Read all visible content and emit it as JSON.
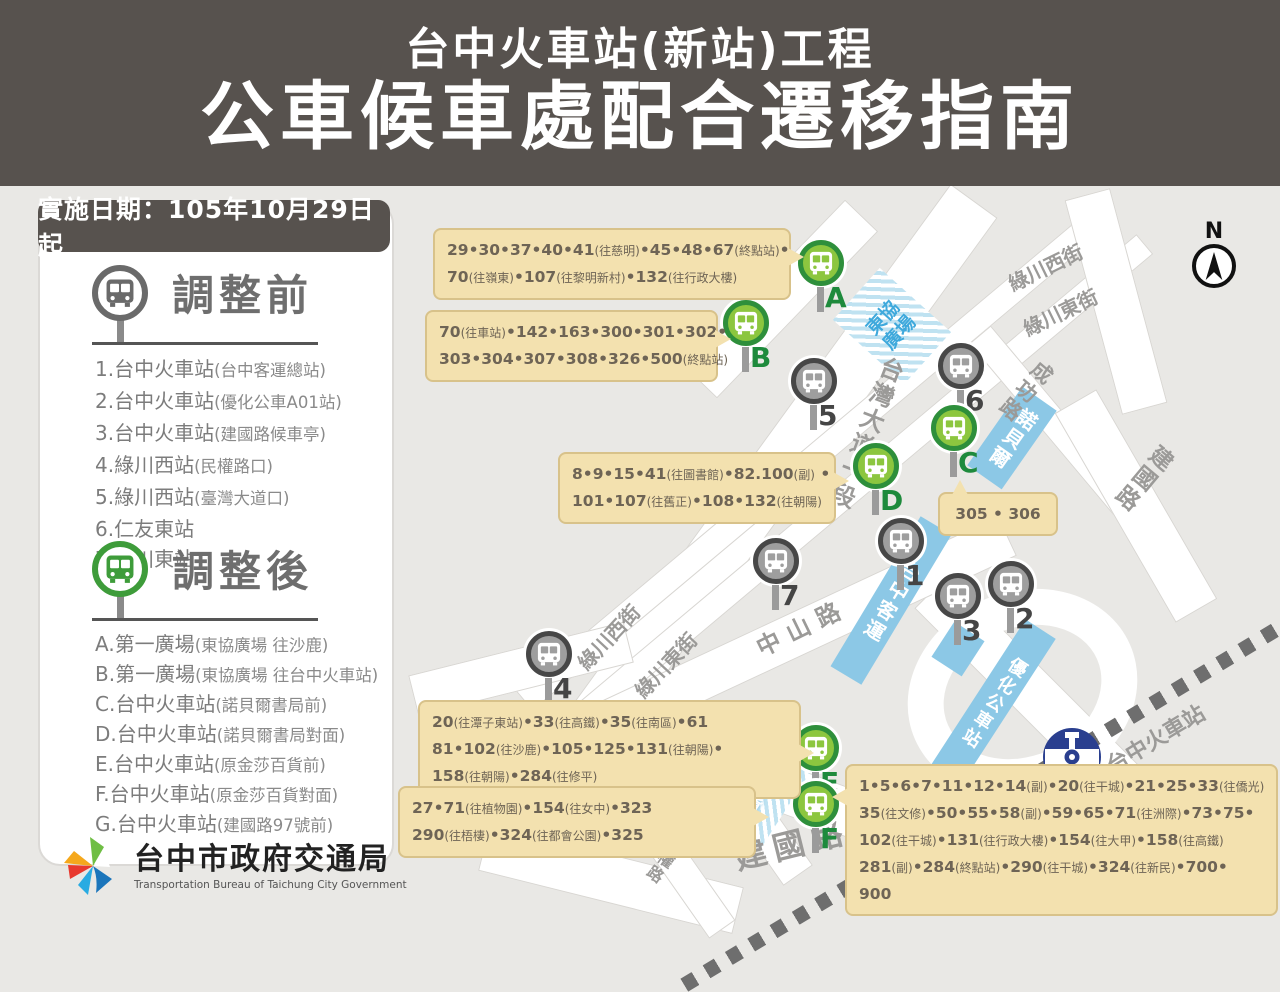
{
  "header": {
    "line1": "台中火車站(新站)工程",
    "line2": "公車候車處配合遷移指南"
  },
  "sidebar": {
    "date_badge": "實施日期：105年10月29日起",
    "before": {
      "title": "調整前",
      "items": [
        "1.台中火車站(台中客運總站)",
        "2.台中火車站(優化公車A01站)",
        "3.台中火車站(建國路候車亭)",
        "4.綠川西站(民權路口)",
        "5.綠川西站(臺灣大道口)",
        "6.仁友東站",
        "7.綠川東站"
      ]
    },
    "after": {
      "title": "調整後",
      "items": [
        "A.第一廣場(東協廣場 往沙鹿)",
        "B.第一廣場(東協廣場 往台中火車站)",
        "C.台中火車站(諾貝爾書局前)",
        "D.台中火車站(諾貝爾書局對面)",
        "E.台中火車站(原金莎百貨前)",
        "F.台中火車站(原金莎百貨對面)",
        "G.台中火車站(建國路97號前)"
      ]
    }
  },
  "logo": {
    "zh": "台中市政府交通局",
    "en": "Transportation Bureau of Taichung City Government"
  },
  "map": {
    "compass": "N",
    "labels": {
      "taiwan_blvd": "台灣大道一段",
      "luchuan_w": "綠川西街",
      "luchuan_e": "綠川東街",
      "chenggong": "成功路",
      "jianguo": "建國路",
      "zhongshan": "中山路",
      "minzu": "民族路",
      "minquan": "民權路",
      "station": "台中火車站"
    },
    "buildings": {
      "dongxie": "東協廣場",
      "nobel": "諾貝爾",
      "jinsha_l1": "原",
      "jinsha_l2": "金莎",
      "jinsha_l3": "百貨",
      "tcbus": "台中客運",
      "brt": "優化公車站"
    },
    "stops": {
      "before": [
        "1",
        "2",
        "3",
        "4",
        "5",
        "6",
        "7"
      ],
      "after": [
        "A",
        "B",
        "C",
        "D",
        "E",
        "F",
        "G"
      ]
    },
    "callouts": {
      "a": {
        "lines": [
          "29•30•37•40•41(往慈明)•45•48•67(終點站)•",
          "70(往嶺東)•107(往黎明新村)•132(往行政大樓)"
        ]
      },
      "b": {
        "lines": [
          "70(往車站)•142•163•300•301•302•",
          "303•304•307•308•326•500(終點站)"
        ]
      },
      "c": {
        "lines": [
          "305 • 306"
        ]
      },
      "d": {
        "lines": [
          "8•9•15•41(往圖書館)•82.100(副) •",
          "101•107(往舊正)•108•132(往朝陽)"
        ]
      },
      "e": {
        "lines": [
          "20(往潭子東站)•33(往高鐵)•35(往南區)•61",
          "81•102(往沙鹿)•105•125•131(往朝陽)•",
          "158(往朝陽)•284(往修平)"
        ]
      },
      "g": {
        "lines": [
          "27•71(往植物園)•154(往女中)•323",
          "290(往梧棲)•324(往都會公園)•325"
        ]
      },
      "f": {
        "lines": [
          "1•5•6•7•11•12•14(副)•20(往干城)•21•25•33(往僑光)",
          "35(往文修)•50•55•58(副)•59•65•71(往洲際)•73•75•",
          "102(往干城)•131(往行政大樓)•154(往大甲)•158(往高鐵)",
          "281(副)•284(終點站)•290(往干城)•324(往新民)•700•",
          "900"
        ]
      }
    }
  },
  "colors": {
    "header_bg": "#57524E",
    "callout_bg": "#F3E1AF",
    "stop_green": "#8CC63F",
    "stop_green_ring": "#2E8F3B",
    "stop_gray": "#9E9E9E",
    "stop_gray_ring": "#474747",
    "building_blue": "#8CC8E6"
  }
}
